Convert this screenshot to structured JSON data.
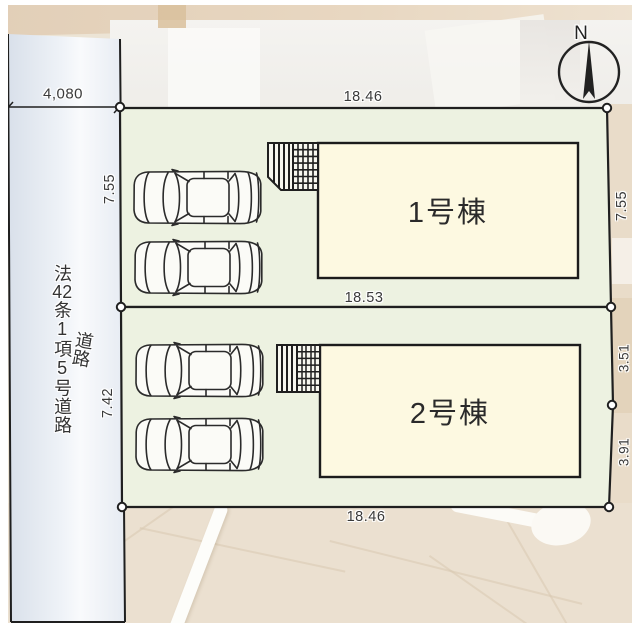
{
  "diagram_type": "real-estate site plan",
  "compass": {
    "north_label": "N"
  },
  "road": {
    "name": "法42条1項5号道路",
    "name_display_segments": [
      "法",
      "42",
      "条",
      "1",
      "項",
      "5",
      "号",
      "道",
      "路"
    ],
    "type_label": "道路",
    "width_dimension": "4,080"
  },
  "plots": [
    {
      "id": "plot-1",
      "building": "1号棟",
      "dimensions": {
        "top": "18.46",
        "left": "7.55",
        "right": "7.55",
        "bottom": "18.53"
      },
      "parking_spaces": 2
    },
    {
      "id": "plot-2",
      "building": "2号棟",
      "dimensions": {
        "left": "7.42",
        "right_upper": "3.51",
        "right_lower": "3.91",
        "bottom": "18.46"
      },
      "parking_spaces": 2
    }
  ],
  "colors": {
    "plot_fill": "#edf2e1",
    "building_fill": "#fdf9e1",
    "porch_fill": "#f7f7ef",
    "road_fill_light": "#f9fafc",
    "road_fill_edge": "#d9e0ea",
    "line": "#1f1f1f",
    "background_beige": "#ece4d5",
    "text": "#333333"
  }
}
